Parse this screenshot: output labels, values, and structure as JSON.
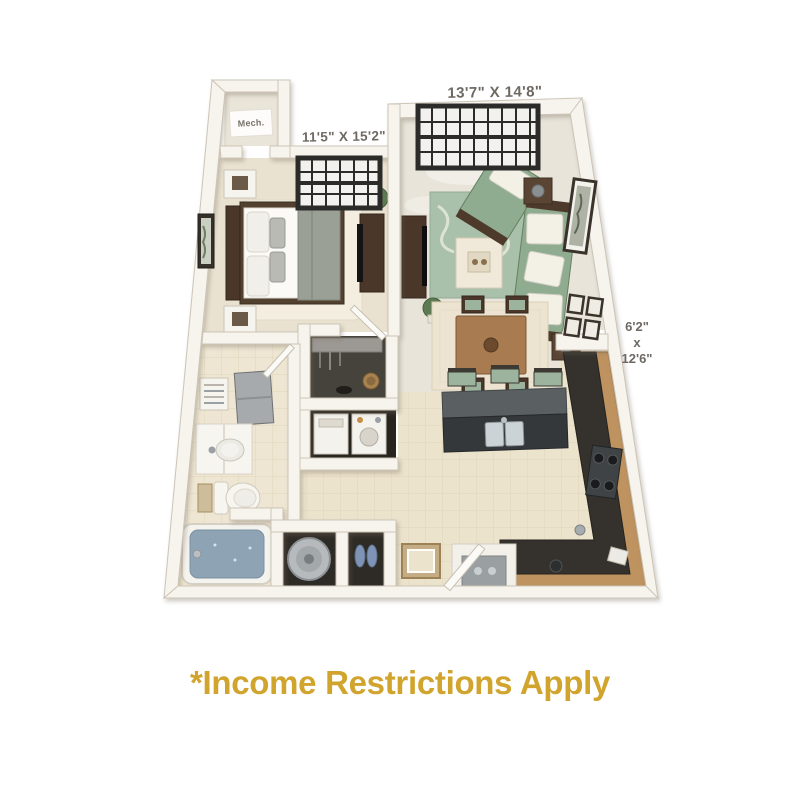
{
  "page": {
    "background": "#ffffff"
  },
  "floorplan": {
    "labels": {
      "living_dim": "13'7\" X 14'8\"",
      "bedroom_dim": "11'5\" X 15'2\"",
      "mech": "Mech.",
      "patio_w": "6'2\"",
      "patio_sep": "x",
      "patio_l": "12'6\""
    },
    "colors": {
      "wall": "#f7f4ee",
      "carpet": "#eae2d1",
      "floor_smooth": "#e8e4da",
      "tile": "#ece3cd",
      "tile_line": "#e0d6bb",
      "bath_tile": "#eee6d2",
      "rug_sage": "#a9c0ab",
      "sofa_sage": "#8fab90",
      "rug_cream": "#f3eee0",
      "wood_dark": "#4a372a",
      "wood_counter": "#bf935f",
      "counter_dark": "#35322e",
      "island_top": "#5a5f61",
      "island_body": "#34383a",
      "stool_green": "#9cb49e",
      "tub_water": "#8ea3b4",
      "closet_dark": "#2e2a25",
      "dim_text": "#6e6963",
      "caption_gold": "#d1a42e"
    }
  },
  "caption": {
    "text": "*Income Restrictions Apply",
    "color": "#d1a42e"
  }
}
